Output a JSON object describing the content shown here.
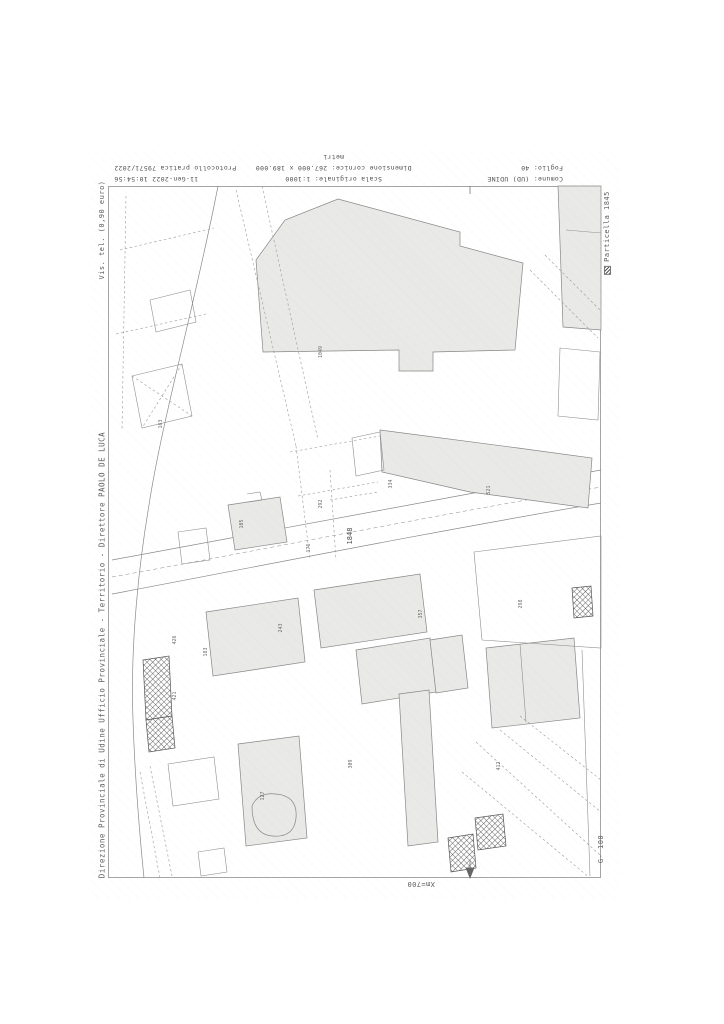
{
  "sheet": {
    "header": {
      "row1": {
        "comune": "Comune: (UD) UDINE",
        "scala": "Scala originale: 1:1000",
        "datetime": "11-Gen-2022 10:54:56"
      },
      "row2": {
        "foglio": "Foglio: 40",
        "dimensione": "Dimensione cornice: 267.000 x 189.000 metri",
        "protocollo": "Protocollo pratica 79571/2022"
      }
    },
    "left_margin": {
      "fee_note": "Vis. tel. (0,90 euro)",
      "office": "Direzione Provinciale di Udine  Ufficio Provinciale - Territorio - Direttore PAOLO DE LUCA"
    },
    "right_margin": {
      "legend_label": "Particella 1845",
      "bottom_code": "G- 100"
    },
    "bottom_margin": {
      "x_grid_label": "Xm=700"
    },
    "map": {
      "featured_parcel": "1848",
      "parcel_labels": [
        {
          "t": "426"
        },
        {
          "t": "421"
        },
        {
          "t": "183"
        },
        {
          "t": "105"
        },
        {
          "t": "292"
        },
        {
          "t": "176"
        },
        {
          "t": "334"
        },
        {
          "t": "521"
        },
        {
          "t": "163"
        },
        {
          "t": "243"
        },
        {
          "t": "357"
        },
        {
          "t": "298"
        },
        {
          "t": "412"
        },
        {
          "t": "127"
        },
        {
          "t": "309"
        },
        {
          "t": "1049"
        }
      ]
    },
    "colors": {
      "paper": "#ffffff",
      "line": "#8a8a8a",
      "building_fill": "#e9e9e7",
      "hatch": "#444444",
      "text": "#5d5d5d"
    }
  }
}
